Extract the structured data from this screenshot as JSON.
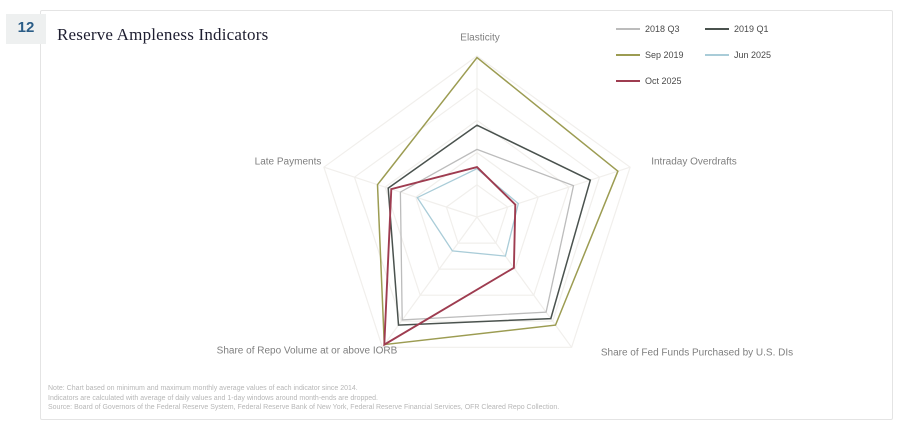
{
  "page": {
    "slide_number": "12",
    "title": "Reserve Ampleness Indicators"
  },
  "legend": {
    "items": [
      {
        "label": "2018 Q3",
        "color": "#bcbcbc"
      },
      {
        "label": "2019 Q1",
        "color": "#4a524e"
      },
      {
        "label": "Sep 2019",
        "color": "#9c9c52"
      },
      {
        "label": "Jun 2025",
        "color": "#a9ccd8"
      },
      {
        "label": "Oct 2025",
        "color": "#9e3c50"
      }
    ]
  },
  "chart_data": {
    "type": "radar",
    "title": "Reserve Ampleness Indicators",
    "axes": [
      "Elasticity",
      "Intraday Overdrafts",
      "Share of Fed Funds Purchased by U.S. DIs",
      "Share of Repo Volume at or above IORB",
      "Late Payments"
    ],
    "scale_min": 0,
    "scale_max": 1,
    "grid_levels": [
      0.2,
      0.4,
      0.6,
      0.8,
      1.0
    ],
    "grid_color": "#f1efec",
    "legend_position": "top-right",
    "series": [
      {
        "name": "2018 Q3",
        "color": "#bcbcbc",
        "width": 1.3,
        "values": [
          0.42,
          0.63,
          0.73,
          0.79,
          0.5
        ]
      },
      {
        "name": "2019 Q1",
        "color": "#4a524e",
        "width": 1.5,
        "values": [
          0.57,
          0.74,
          0.78,
          0.83,
          0.58
        ]
      },
      {
        "name": "Sep 2019",
        "color": "#9c9c52",
        "width": 1.5,
        "values": [
          0.99,
          0.92,
          0.83,
          0.98,
          0.65
        ]
      },
      {
        "name": "Jun 2025",
        "color": "#a9ccd8",
        "width": 1.3,
        "values": [
          0.3,
          0.27,
          0.3,
          0.26,
          0.39
        ]
      },
      {
        "name": "Oct 2025",
        "color": "#9e3c50",
        "width": 1.9,
        "values": [
          0.31,
          0.25,
          0.39,
          0.98,
          0.56
        ]
      }
    ]
  },
  "footnotes": {
    "line1": "Note: Chart based on minimum and maximum monthly average values of each indicator since 2014.",
    "line2": "Indicators are calculated with average of daily values and 1-day windows around month-ends are dropped.",
    "line3": "Source: Board of Governors of the Federal Reserve System, Federal Reserve Bank of New York, Federal Reserve Financial Services, OFR Cleared Repo Collection."
  }
}
